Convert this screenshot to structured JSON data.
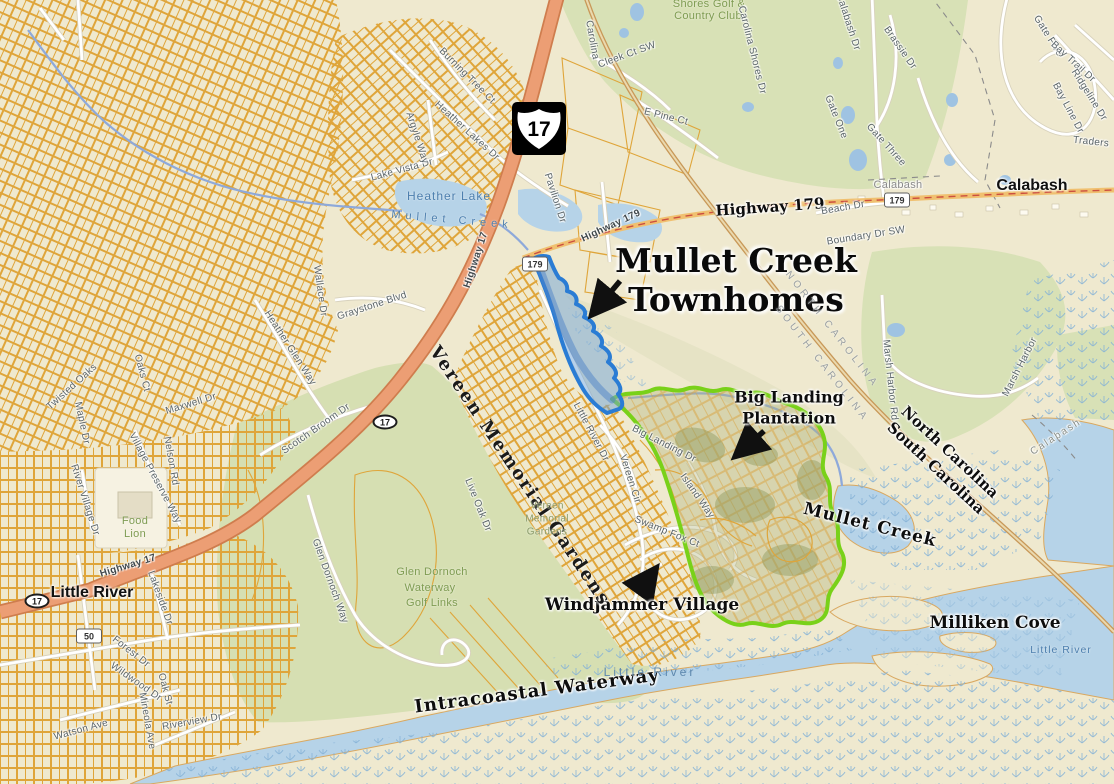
{
  "ann": {
    "title1": "Mullet Creek",
    "title2": "Townhomes",
    "bigland1": "Big Landing",
    "bigland2": "Plantation",
    "windjammer": "Windjammer Village",
    "milliken": "Milliken Cove",
    "mullet_creek": "Mullet Creek",
    "intracoastal": "Intracoastal Waterway",
    "nc": "North Carolina",
    "sc": "South Carolina",
    "little_river": "Little River",
    "calabash": "Calabash",
    "hwy179": "Highway 179"
  },
  "state_line": {
    "n": "NORTH CAROLINA",
    "s": "SOUTH CAROLINA"
  },
  "shields": {
    "us17": "17",
    "sc17a": "17",
    "sc17b": "17",
    "r179a": "179",
    "r179b": "179",
    "r50": "50"
  },
  "water": {
    "heather_lake": "Heather Lake",
    "mullet_stream": "Mullet Creek",
    "little_river_ch": "Little River",
    "little_river_e": "Little River"
  },
  "parks": {
    "shores1": "Shores Golf &",
    "shores2": "Country Club",
    "glen1": "Glen Dornoch",
    "glen2": "Waterway",
    "glen3": "Golf Links",
    "vereen_big": "Vereen Memorial Gardens",
    "vereen1": "Vereen",
    "vereen2": "Memorial",
    "vereen3": "Gardens",
    "food1": "Food",
    "food2": "Lion",
    "calabash_small": "Calabash",
    "calabash_creek": "Calabash"
  },
  "streets": [
    {
      "t": "Cleek Ct SW"
    },
    {
      "t": "E Pine Ct"
    },
    {
      "t": "Carolina Shores Dr"
    },
    {
      "t": "Carolina"
    },
    {
      "t": "Brassie Dr"
    },
    {
      "t": "Calabash Dr"
    },
    {
      "t": "Gate One"
    },
    {
      "t": "Gate Three"
    },
    {
      "t": "Gate Five"
    },
    {
      "t": "Bay Trail Dr"
    },
    {
      "t": "Ridgeline Dr"
    },
    {
      "t": "Bay Line Dr"
    },
    {
      "t": "Traders"
    },
    {
      "t": "Beach Dr"
    },
    {
      "t": "Boundary Dr SW"
    },
    {
      "t": "Marsh Harbor Rd"
    },
    {
      "t": "Marsh Harbor"
    },
    {
      "t": "Pavilion Dr"
    },
    {
      "t": "Heather Lakes Dr"
    },
    {
      "t": "Burning Tree Ct"
    },
    {
      "t": "Lake Vista Dr"
    },
    {
      "t": "Argyle Way"
    },
    {
      "t": "Heather Glen Way"
    },
    {
      "t": "Wallace Dr"
    },
    {
      "t": "Graystone Blvd"
    },
    {
      "t": "Scotch Broom Dr"
    },
    {
      "t": "Twisted Oaks"
    },
    {
      "t": "Oaks Ct"
    },
    {
      "t": "Maple Dr"
    },
    {
      "t": "Maxwell Dr"
    },
    {
      "t": "Nelson Rd"
    },
    {
      "t": "River Village Dr"
    },
    {
      "t": "Village Preserve Way"
    },
    {
      "t": "Highway 17"
    },
    {
      "t": "Highway 17"
    },
    {
      "t": "Highway 179"
    },
    {
      "t": "Little River Dr"
    },
    {
      "t": "Vereen Cir"
    },
    {
      "t": "Swamp Fox Ct"
    },
    {
      "t": "Big Landing Dr"
    },
    {
      "t": "Island Way"
    },
    {
      "t": "Glen Dornoch Way"
    },
    {
      "t": "Live Oak Dr"
    },
    {
      "t": "Forest Dr"
    },
    {
      "t": "Wildwood Dr"
    },
    {
      "t": "Lakeside Dr"
    },
    {
      "t": "Watson Ave"
    },
    {
      "t": "Mineola Ave"
    },
    {
      "t": "Riverview Dr"
    },
    {
      "t": "Oak St"
    }
  ],
  "colors": {
    "region_blue": "#2a7cd4",
    "region_green": "#79d119",
    "water": "#b6d3e8",
    "highway": "#ec9e74",
    "parcel": "#dfa53a"
  }
}
